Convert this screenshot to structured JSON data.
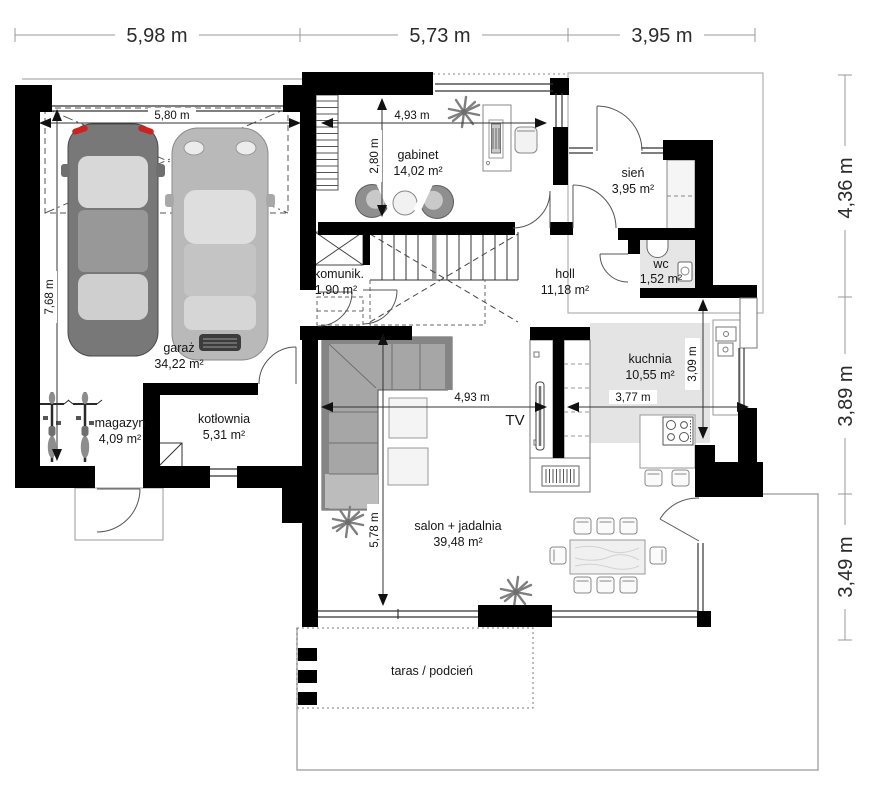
{
  "plan": {
    "rooms": {
      "garaz": {
        "name": "garaż",
        "area": "34,22 m²"
      },
      "magazyn": {
        "name": "magazyn",
        "area": "4,09 m²"
      },
      "kotlownia": {
        "name": "kotłownia",
        "area": "5,31 m²"
      },
      "komunik": {
        "name": "komunik.",
        "area": "1,90 m²"
      },
      "gabinet": {
        "name": "gabinet",
        "area": "14,02 m²"
      },
      "sien": {
        "name": "sień",
        "area": "3,95 m²"
      },
      "wc": {
        "name": "wc",
        "area": "1,52 m²"
      },
      "holl": {
        "name": "holl",
        "area": "11,18 m²"
      },
      "kuchnia": {
        "name": "kuchnia",
        "area": "10,55 m²"
      },
      "salon": {
        "name": "salon + jadalnia",
        "area": "39,48 m²"
      },
      "taras": {
        "name": "taras / podcień"
      }
    },
    "dims": {
      "top": [
        "5,98 m",
        "5,73 m",
        "3,95 m"
      ],
      "right": [
        "4,36 m",
        "3,89 m",
        "3,49 m"
      ],
      "garage_width": "5,80 m",
      "garage_depth": "7,68 m",
      "gabinet_width": "4,93 m",
      "gabinet_depth": "2,80 m",
      "salon_width": "4,93 m",
      "salon_depth": "5,78 m",
      "kitchen_width": "3,77 m",
      "kitchen_depth": "3,09 m"
    },
    "labels": {
      "tv": "TV"
    },
    "colors": {
      "wall": "#000000",
      "dim_line": "#999999",
      "floor_tint": "#e1e1e1",
      "sofa": "#a6a6a6",
      "accent_red": "#cc2222"
    }
  }
}
